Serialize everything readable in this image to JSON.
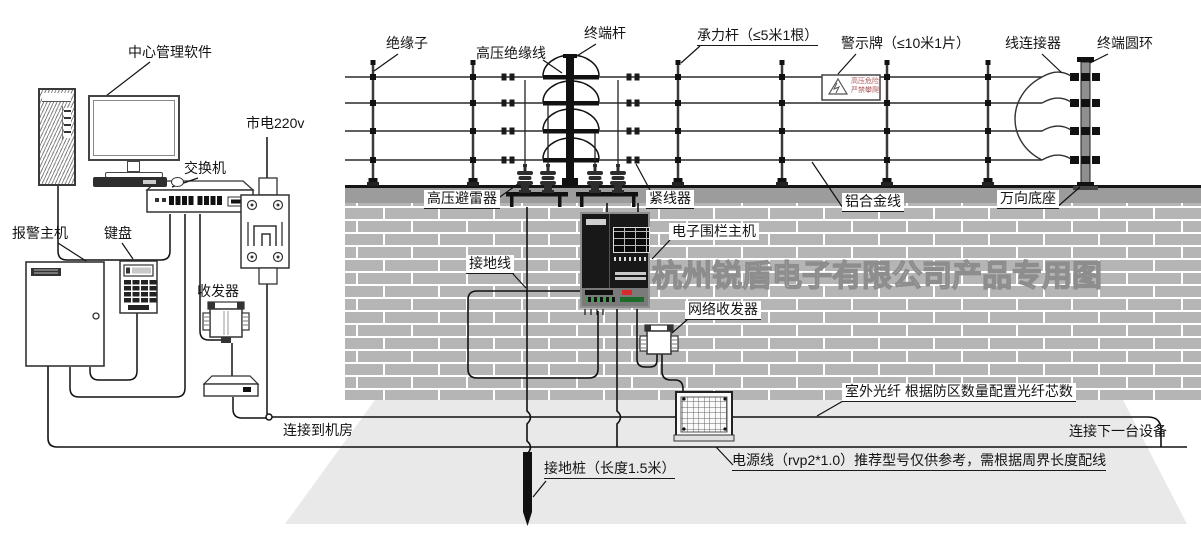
{
  "labels": {
    "software": "中心管理软件",
    "mains": "市电220v",
    "switch": "交换机",
    "alarm_host": "报警主机",
    "keypad": "键盘",
    "transceiver": "收发器",
    "insulator": "绝缘子",
    "hv_cable": "高压绝缘线",
    "terminal_pole": "终端杆",
    "load_pole": "承力杆（≤5米1根）",
    "warning_sign": "警示牌（≤10米1片）",
    "wire_connector": "线连接器",
    "terminal_ring": "终端圆环",
    "arrester": "高压避雷器",
    "tensioner": "紧线器",
    "aluminum_wire": "铝合金线",
    "universal_base": "万向底座",
    "fence_host": "电子围栏主机",
    "ground_wire": "接地线",
    "network_transceiver": "网络收发器",
    "outdoor_fiber": "室外光纤 根据防区数量配置光纤芯数",
    "to_machine_room": "连接到机房",
    "to_next_device": "连接下一台设备",
    "ground_stake": "接地桩（长度1.5米）",
    "power_line": "电源线（rvp2*1.0）推荐型号仅供参考，需根据周界长度配线"
  },
  "warning_sign": {
    "line1": "高压危险",
    "line2": "严禁攀爬"
  },
  "watermark": "杭州锐盾电子有限公司产品专用图",
  "colors": {
    "brick": "#b5b5b5",
    "wall_cap": "#9c9c9c",
    "ground": "#e9e9e9",
    "line": "#111111",
    "alert_red": "#d62b2b",
    "sign_text": "#b05a5a"
  }
}
